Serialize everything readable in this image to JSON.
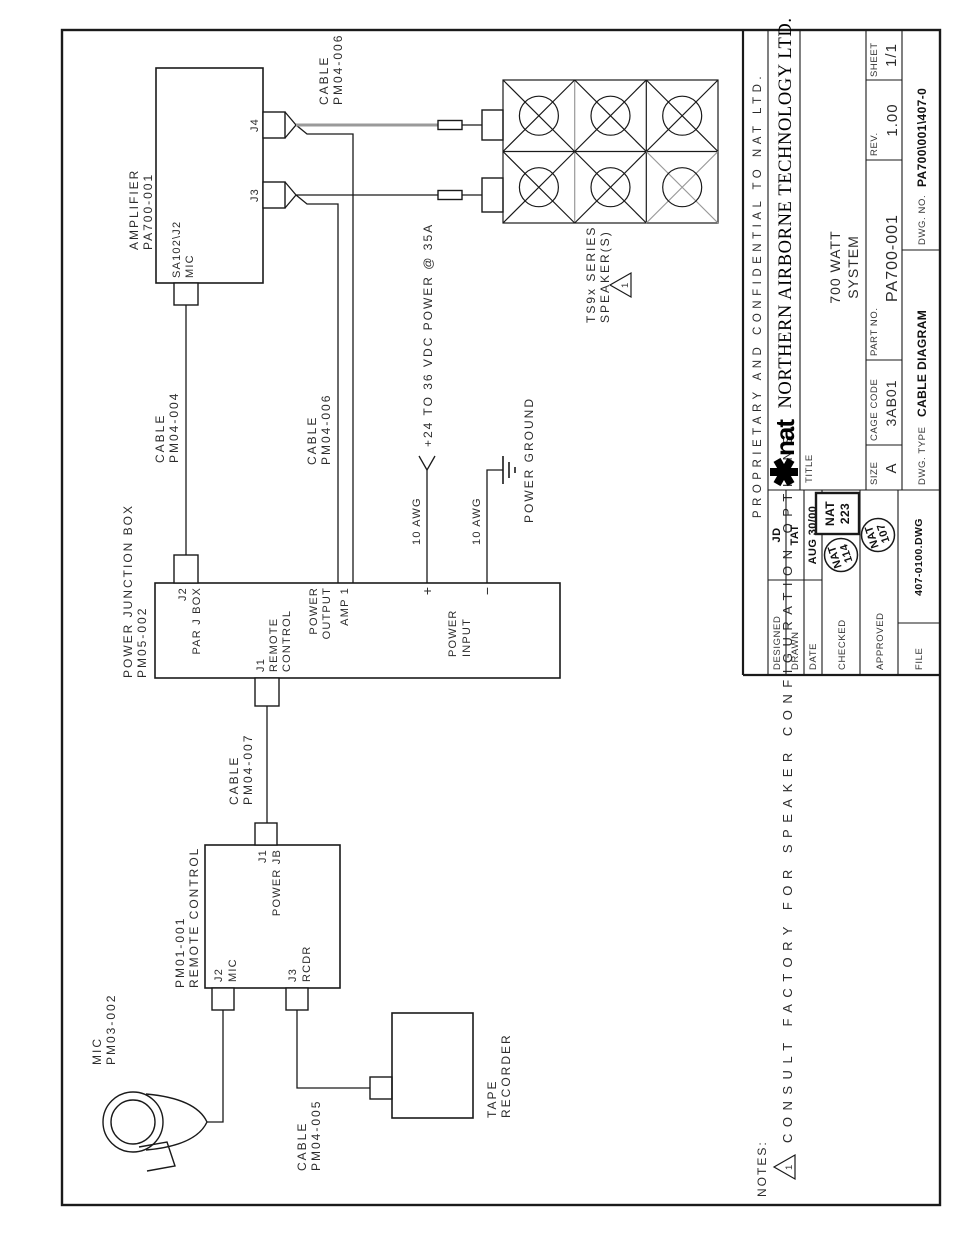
{
  "title_block": {
    "proprietary": "PROPRIETARY AND CONFIDENTIAL TO NAT LTD.",
    "logo": {
      "brand": "nat"
    },
    "company": "NORTHERN AIRBORNE TECHNOLOGY LTD.",
    "title_label": "TITLE",
    "title_line1": "700 WATT",
    "title_line2": "SYSTEM",
    "size_label": "SIZE",
    "size_value": "A",
    "cage_code_label": "CAGE CODE",
    "cage_code_value": "3AB01",
    "part_no_label": "PART NO.",
    "part_no_value": "PA700-001",
    "rev_label": "REV.",
    "rev_value": "1.00",
    "sheet_label": "SHEET",
    "sheet_value": "1/1",
    "dwg_type_label": "DWG. TYPE",
    "dwg_type_value": "CABLE DIAGRAM",
    "dwg_no_label": "DWG. NO.",
    "dwg_no_value": "PA700\\001\\407-0",
    "designed_label": "DESIGNED",
    "designed_value": "JD",
    "drawn_label": "DRAWN",
    "drawn_value": "TAT",
    "date_label": "DATE",
    "date_value": "AUG 30/00",
    "checked_label": "CHECKED",
    "approved_label": "APPROVED",
    "file_label": "FILE",
    "file_value": "407-0100.DWG",
    "stamp_checked_1": {
      "line1": "NAT",
      "line2": "114"
    },
    "stamp_checked_2": {
      "line1": "NAT",
      "line2": "223"
    },
    "stamp_approved": {
      "line1": "NAT",
      "line2": "107"
    }
  },
  "notes": {
    "heading": "NOTES:",
    "note_1": {
      "marker": "1",
      "text": "CONSULT FACTORY FOR SPEAKER CONFIGURATION OPTIONS."
    }
  },
  "components": {
    "amplifier": {
      "name_line1": "AMPLIFIER",
      "name_line2": "PA700-001",
      "mic_conn_line1": "SA102\\J2",
      "mic_conn_line2": "MIC",
      "j3": "J3",
      "j4": "J4"
    },
    "junction_box": {
      "name_line1": "POWER JUNCTION BOX",
      "name_line2": "PM05-002",
      "j2_line1": "J2",
      "j2_line2": "PAR J BOX",
      "j1_line1": "J1",
      "j1_line2": "REMOTE",
      "j1_line3": "CONTROL",
      "output_line1": "POWER",
      "output_line2": "OUTPUT",
      "output_line3": "AMP 1",
      "input_line1": "POWER",
      "input_line2": "INPUT",
      "plus": "+",
      "minus": "−"
    },
    "remote_control": {
      "name_line1": "PM01-001",
      "name_line2": "REMOTE CONTROL",
      "j1_line1": "J1",
      "j1_line2": "POWER JB",
      "j2_line1": "J2",
      "j2_line2": "MIC",
      "j3_line1": "J3",
      "j3_line2": "RCDR"
    },
    "microphone": {
      "name_line1": "MIC",
      "name_line2": "PM03-002"
    },
    "tape_recorder": {
      "name_line1": "TAPE",
      "name_line2": "RECORDER"
    },
    "speakers": {
      "name_line1": "TS9x SERIES",
      "name_line2": "SPEAKER(S)",
      "note_marker": "1"
    }
  },
  "cables": {
    "pm04_004": {
      "line1": "CABLE",
      "line2": "PM04-004"
    },
    "pm04_006_amp": {
      "line1": "CABLE",
      "line2": "PM04-006"
    },
    "pm04_006_jb": {
      "line1": "CABLE",
      "line2": "PM04-006"
    },
    "pm04_007": {
      "line1": "CABLE",
      "line2": "PM04-007"
    },
    "pm04_005": {
      "line1": "CABLE",
      "line2": "PM04-005"
    }
  },
  "power": {
    "awg_positive": "10 AWG",
    "awg_negative": "10 AWG",
    "supply": "+24 TO 36 VDC POWER @ 35A",
    "ground": "POWER GROUND"
  },
  "colors": {
    "line": "#1a1a1a",
    "gray_wire": "#9a9a9a",
    "text": "#2b2b2b"
  }
}
